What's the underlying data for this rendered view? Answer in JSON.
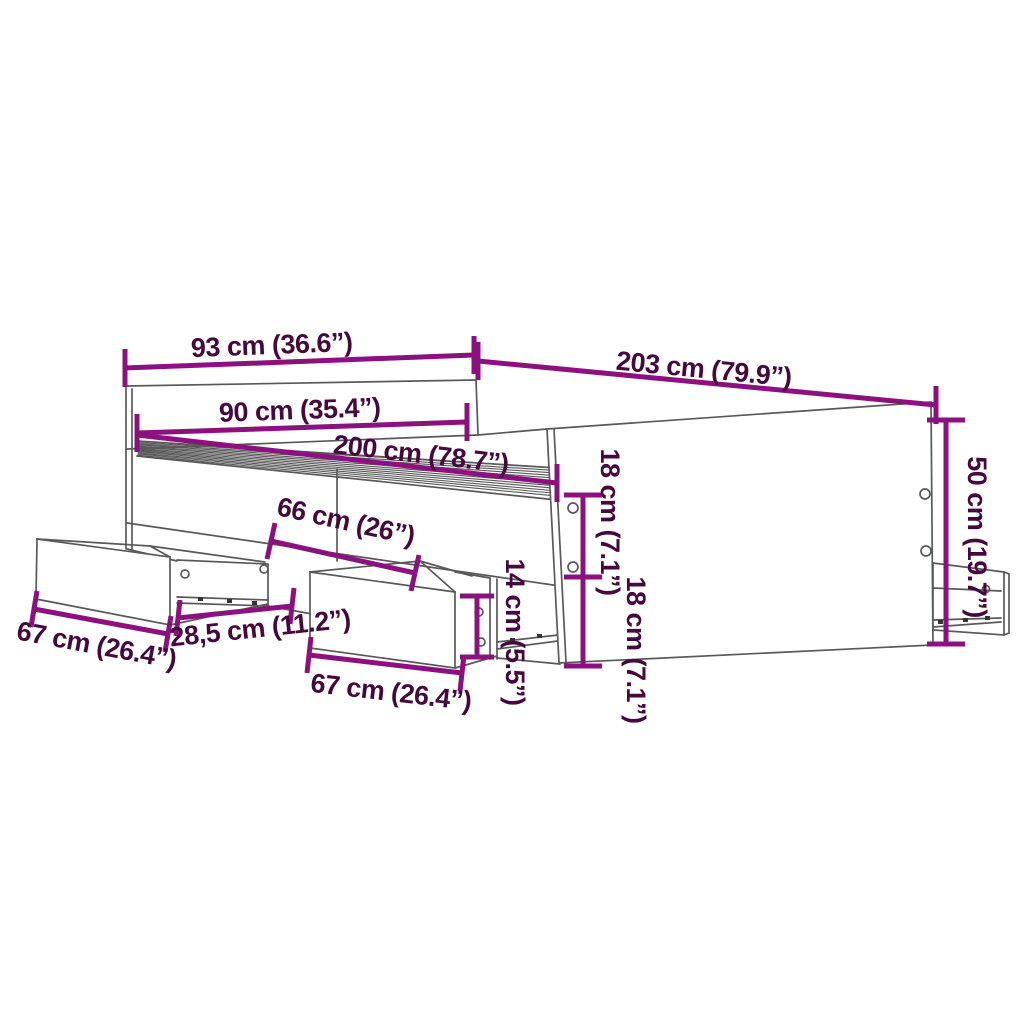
{
  "diagram": {
    "type": "furniture-dimension-diagram",
    "subject": "bed-frame-with-storage-drawers",
    "units": [
      "cm",
      "inches"
    ],
    "colors": {
      "background": "#ffffff",
      "dimension_line": "#8C107E",
      "dimension_text": "#45093E",
      "structure_line": "#595959"
    },
    "dimensions": [
      {
        "id": "headboard-outer-width",
        "label": "93 cm (36.6”)",
        "cm": 93,
        "inch": 36.6
      },
      {
        "id": "frame-total-length",
        "label": "203 cm (79.9”)",
        "cm": 203,
        "inch": 79.9
      },
      {
        "id": "inner-width",
        "label": "90 cm (35.4”)",
        "cm": 90,
        "inch": 35.4
      },
      {
        "id": "inner-length",
        "label": "200 cm (78.7”)",
        "cm": 200,
        "inch": 78.7
      },
      {
        "id": "drawer-opening-span",
        "label": "66 cm (26”)",
        "cm": 66,
        "inch": 26
      },
      {
        "id": "divider-width",
        "label": "28,5 cm (11.2”)",
        "cm": 28.5,
        "inch": 11.2
      },
      {
        "id": "drawer-left-width",
        "label": "67 cm (26.4”)",
        "cm": 67,
        "inch": 26.4
      },
      {
        "id": "drawer-middle-width",
        "label": "67 cm (26.4”)",
        "cm": 67,
        "inch": 26.4
      },
      {
        "id": "drawer-front-height",
        "label": "14 cm (5.5”)",
        "cm": 14,
        "inch": 5.5
      },
      {
        "id": "rail-upper-height",
        "label": "18 cm (7.1”)",
        "cm": 18,
        "inch": 7.1
      },
      {
        "id": "rail-lower-height",
        "label": "18 cm (7.1”)",
        "cm": 18,
        "inch": 7.1
      },
      {
        "id": "side-panel-height",
        "label": "50 cm (19.7”)",
        "cm": 50,
        "inch": 19.7
      }
    ]
  }
}
